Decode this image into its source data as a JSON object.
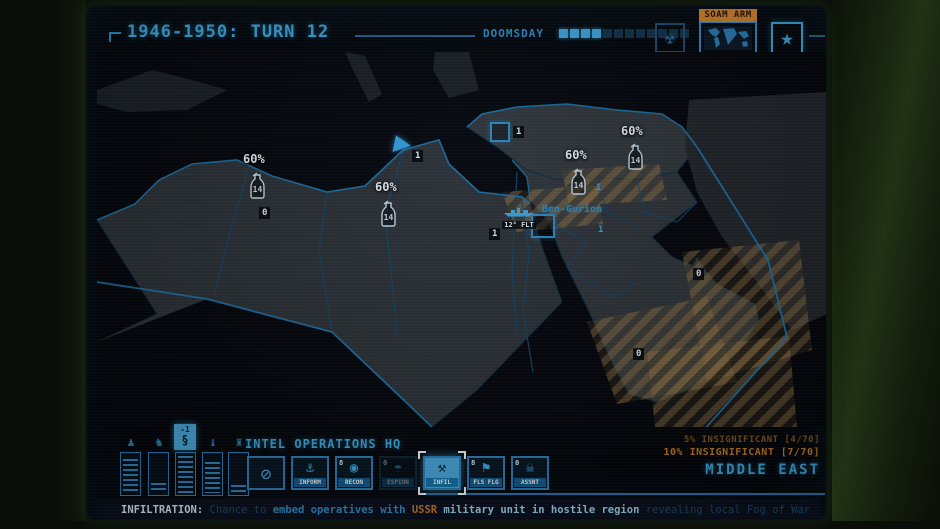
{
  "header": {
    "title": "1946-1950: TURN 12",
    "doomsday": {
      "label": "DOOMSDAY",
      "filled": 4,
      "total": 12
    },
    "soam_badge": "SOAM ARM"
  },
  "menu": {
    "items": [
      {
        "label": "FOCUS MGMT",
        "selected": false
      },
      {
        "label": "THEATER COM",
        "selected": true
      },
      {
        "label": "STATE AFFAIRS",
        "selected": false
      },
      {
        "label": "OPTIONS",
        "selected": false
      },
      {
        "label": "SURRENDER",
        "selected": false
      }
    ]
  },
  "scores": {
    "rows": [
      {
        "label": "USA",
        "value": "0"
      },
      {
        "label": "USSR",
        "value": "0"
      }
    ],
    "counter": "77",
    "fp_label": "FP"
  },
  "map": {
    "units": [
      {
        "percent": "60%",
        "value": "14"
      },
      {
        "percent": "60%",
        "value": "14"
      },
      {
        "percent": "60%",
        "value": "14"
      },
      {
        "percent": "60%",
        "value": "14"
      }
    ],
    "chips": [
      {
        "value": "1"
      },
      {
        "value": "1"
      },
      {
        "value": "0"
      },
      {
        "value": "1"
      },
      {
        "value": "1"
      },
      {
        "value": "1"
      },
      {
        "value": "0"
      },
      {
        "value": "0"
      }
    ],
    "fleet": {
      "label": "12° FLT"
    },
    "city": {
      "label": "Ben-Gurion"
    }
  },
  "stats_panel": {
    "modifier": "-1",
    "symbol": "§"
  },
  "intel": {
    "title": "INTEL OPERATIONS HQ",
    "buttons": [
      {
        "label": "",
        "badge": ""
      },
      {
        "label": "INFORM",
        "badge": ""
      },
      {
        "label": "RECON",
        "badge": "8"
      },
      {
        "label": "ESPION",
        "badge": "0"
      },
      {
        "label": "INFIL",
        "badge": ""
      },
      {
        "label": "FLS FLG",
        "badge": "8"
      },
      {
        "label": "ASSNT",
        "badge": "0"
      }
    ]
  },
  "region": {
    "line1": "5% INSIGNIFICANT [4/70]",
    "line2": "10% INSIGNIFICANT [7/70]",
    "name": "MIDDLE EAST"
  },
  "statusbar": {
    "segments": [
      {
        "text": "INFILTRATION:"
      },
      {
        "text": " Chance to "
      },
      {
        "text": "embed operatives with "
      },
      {
        "text": "USSR"
      },
      {
        "text": " military unit in hostile region "
      },
      {
        "text": "revealing local Fog of War"
      }
    ]
  },
  "colors": {
    "accent": "#3fa9e0",
    "orange": "#c87a20",
    "soam_badge_bg": "#d8862c"
  }
}
